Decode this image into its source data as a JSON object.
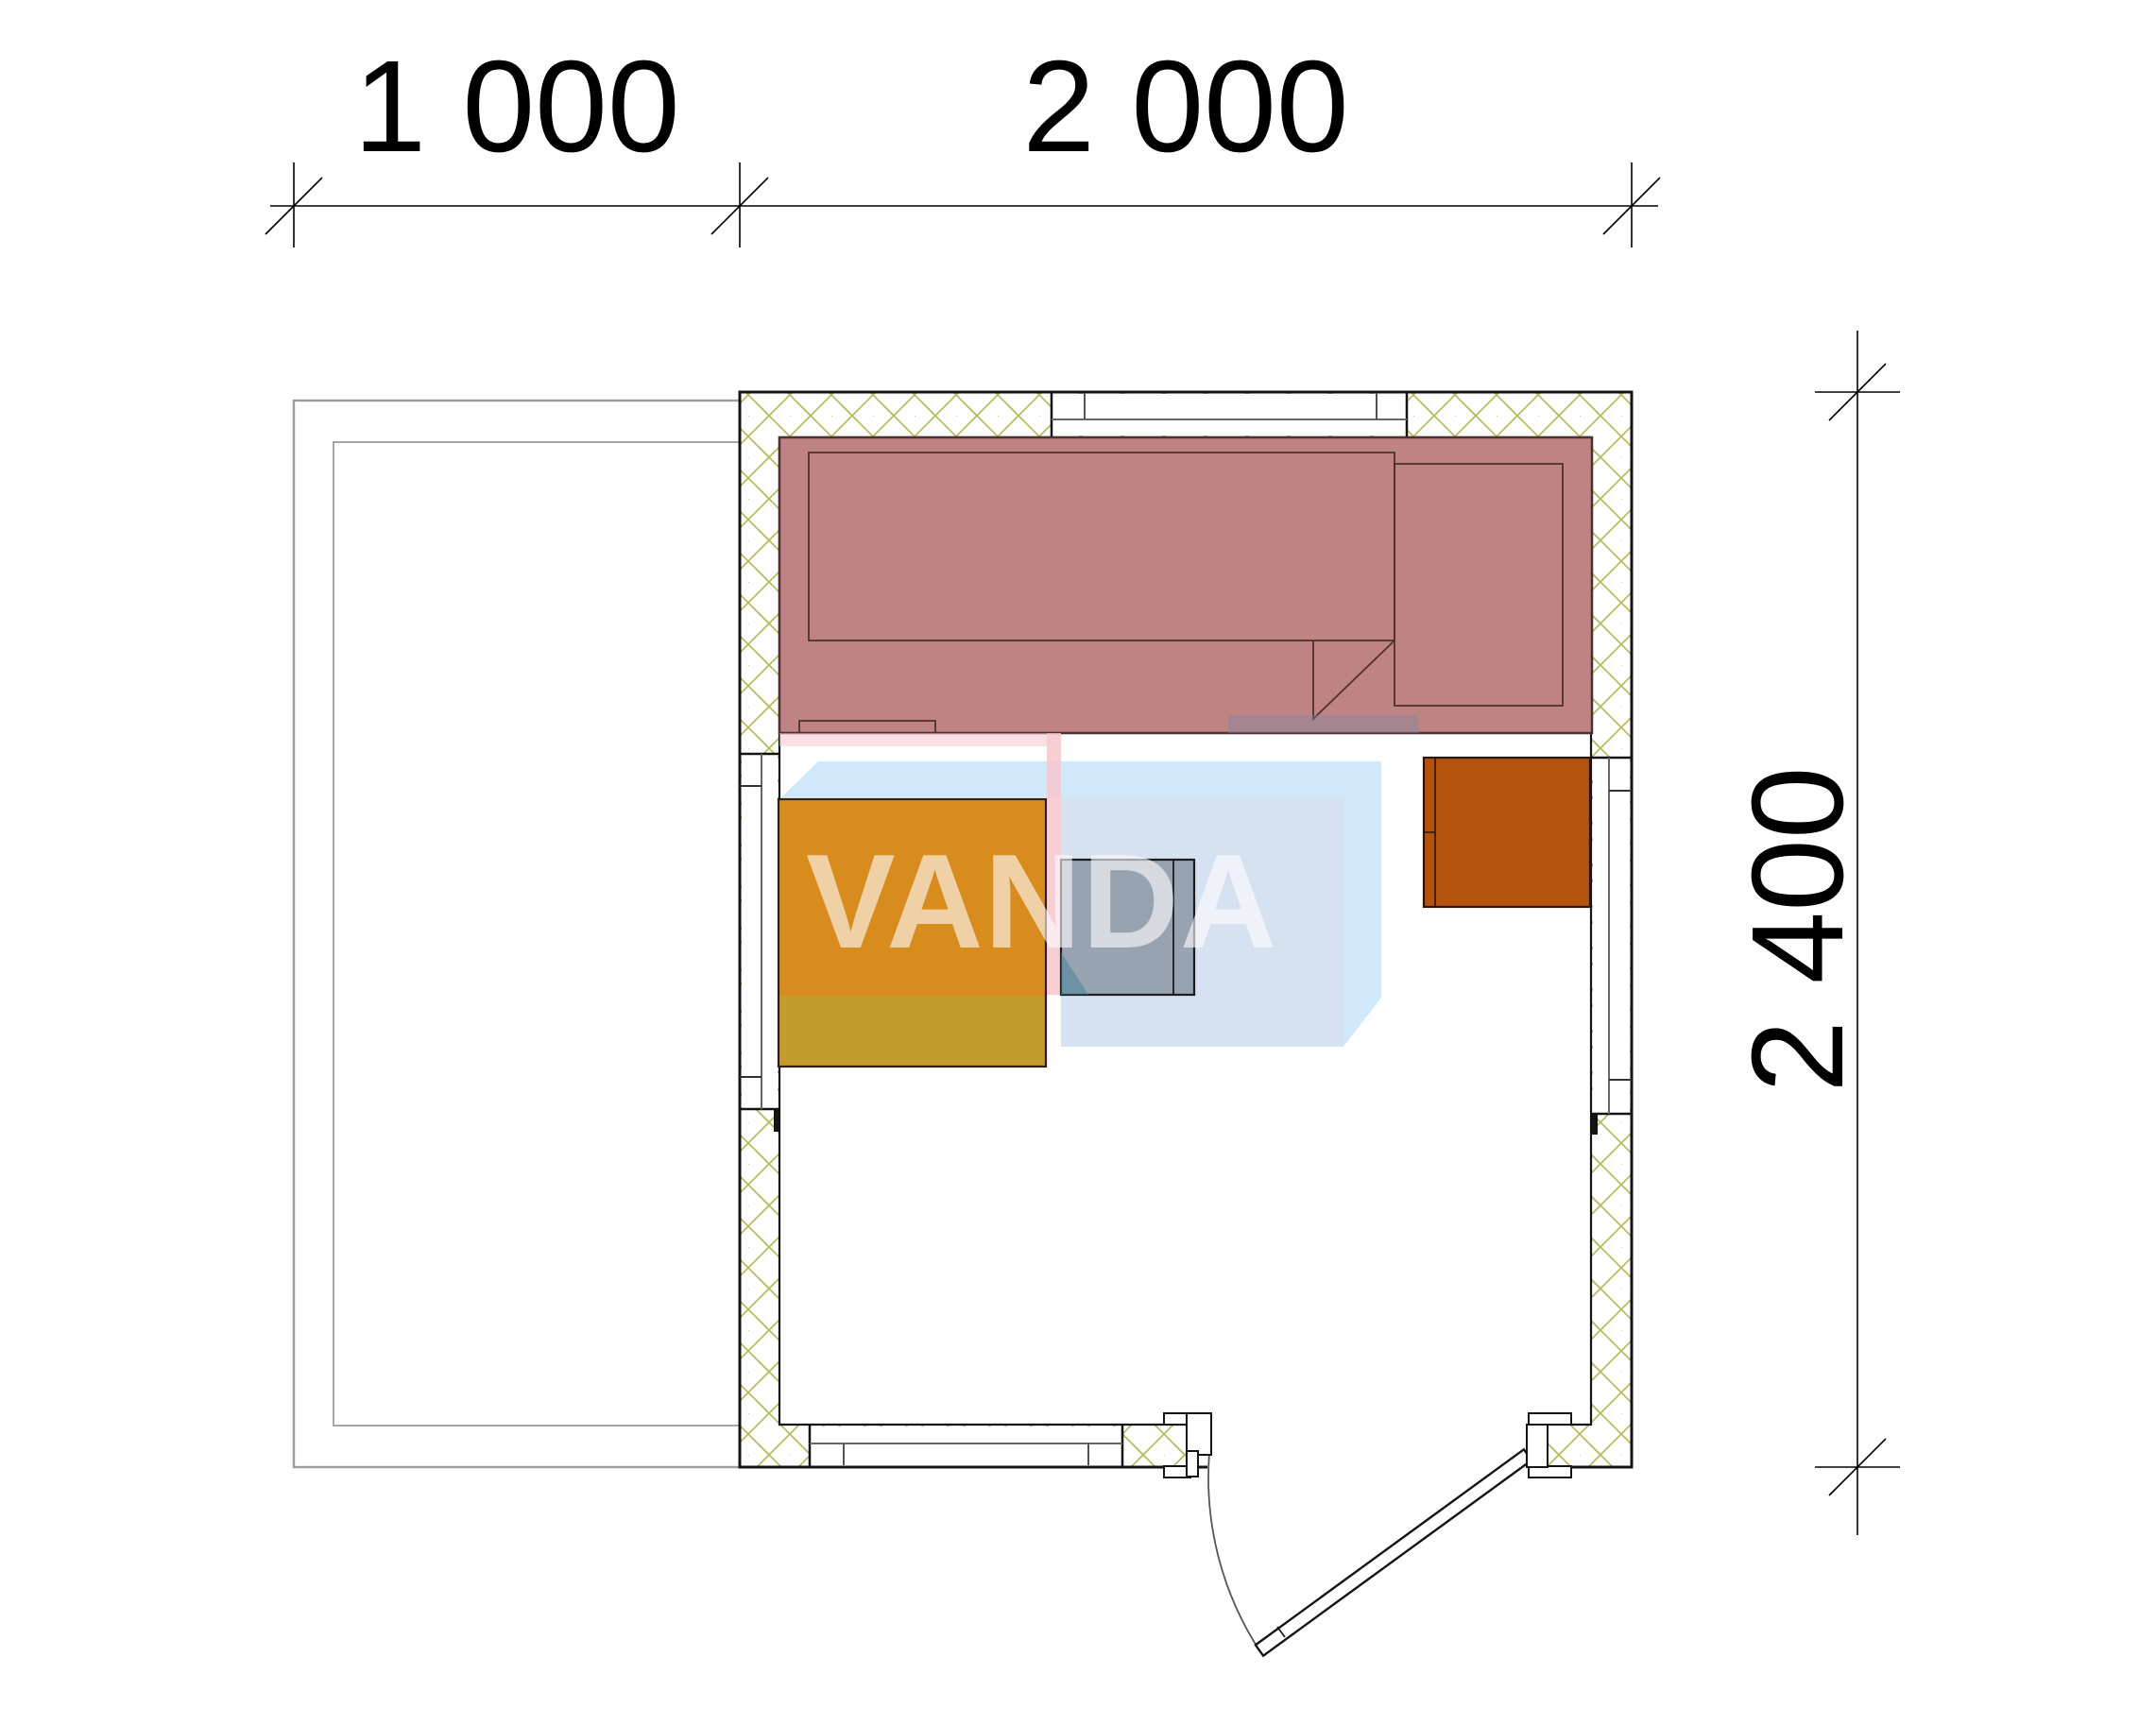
{
  "drawing": {
    "type": "floor-plan",
    "dimension_labels": {
      "terrace_width": "1 000",
      "cabin_width": "2 000",
      "cabin_depth": "2 400"
    },
    "watermark": {
      "text": "VANDA"
    },
    "colors": {
      "bench_fill": "#c08384",
      "bench_outline": "#4f3030",
      "cabinet_fill": "#d98c1e",
      "cabinet_band": "#c49b2e",
      "heater_fill": "#b4520f",
      "stove_fill": "#5a6674",
      "hatch_line": "#b9bd62",
      "wall_line": "#141414",
      "terrace_line": "#9c9c9c",
      "watermark_blue": "#c7e5f9",
      "watermark_lavender": "#ccd9ee",
      "watermark_pink": "#f6c6cd",
      "watermark_teal": "#3f7d96",
      "dimension_color": "#000000"
    }
  }
}
